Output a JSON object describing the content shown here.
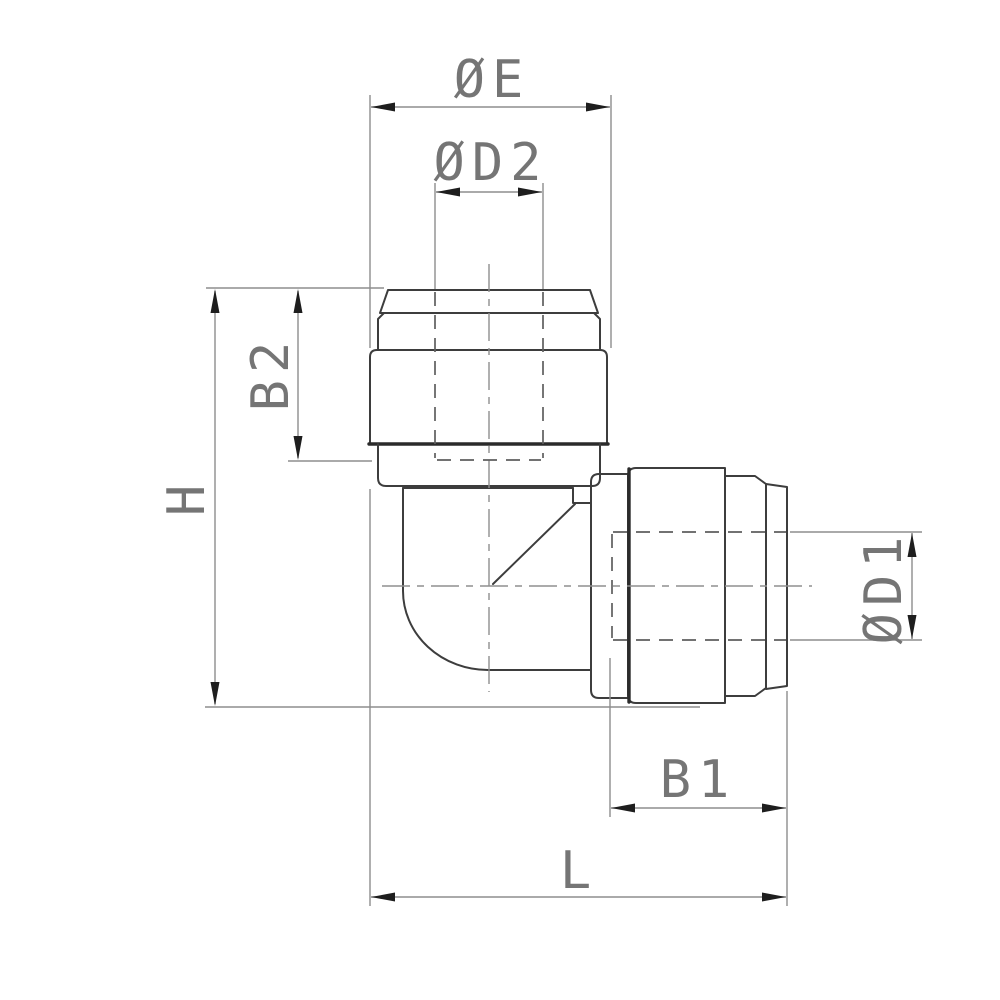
{
  "drawing_labels": {
    "top_outer_diameter": "ØE",
    "top_bore_diameter": "ØD2",
    "top_insertion_depth": "B2",
    "overall_height": "H",
    "side_bore_diameter": "ØD1",
    "side_insertion_depth": "B1",
    "overall_length": "L"
  }
}
